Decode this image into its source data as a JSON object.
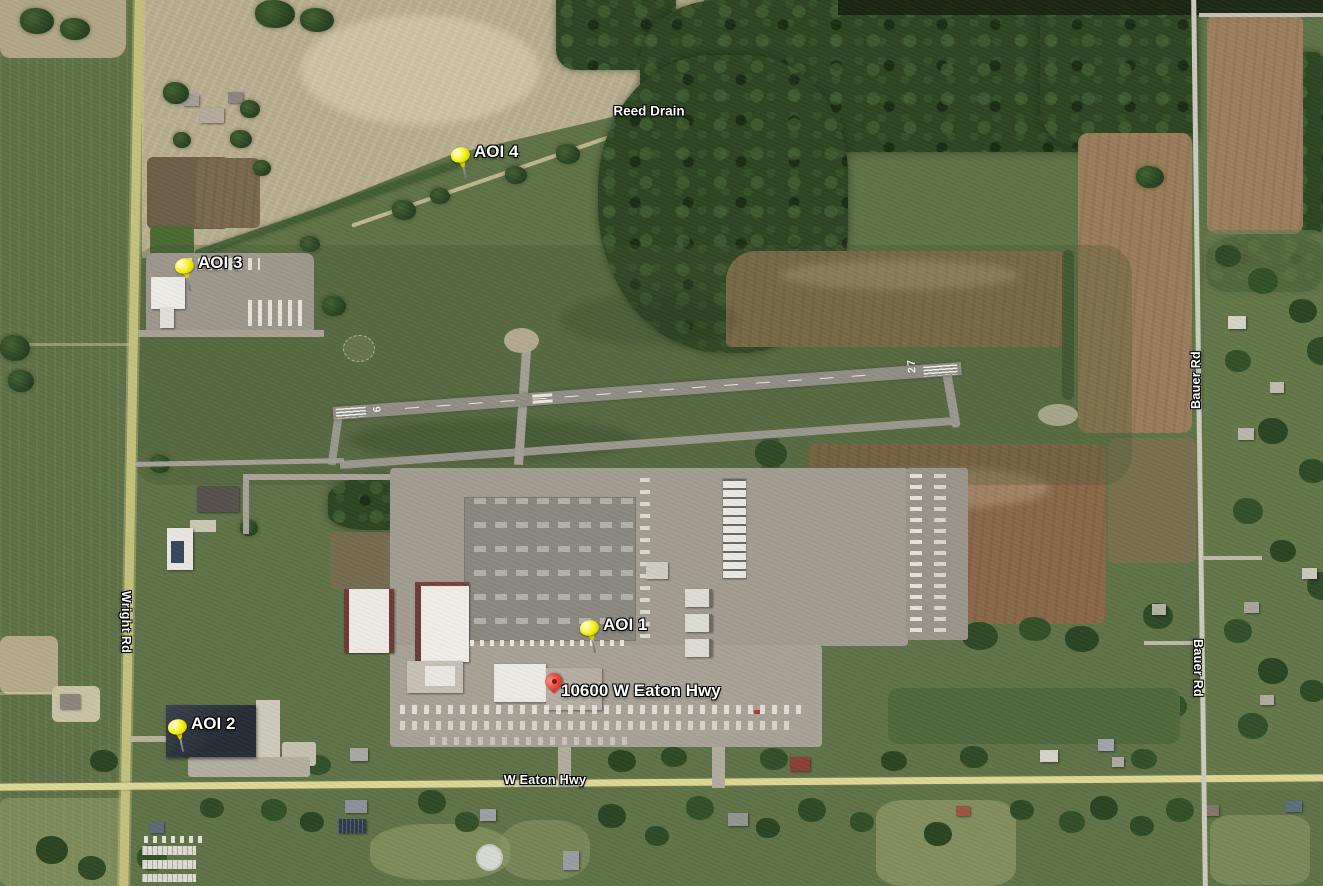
{
  "markers": {
    "pins": [
      {
        "id": "aoi-1",
        "label": "AOI 1",
        "x": 589,
        "y": 653,
        "type": "yellow-pushpin",
        "color": "#f6ec0e"
      },
      {
        "id": "aoi-2",
        "label": "AOI 2",
        "x": 177,
        "y": 752,
        "type": "yellow-pushpin",
        "color": "#f6ec0e"
      },
      {
        "id": "aoi-3",
        "label": "AOI 3",
        "x": 184,
        "y": 291,
        "type": "yellow-pushpin",
        "color": "#f6ec0e"
      },
      {
        "id": "aoi-4",
        "label": "AOI 4",
        "x": 460,
        "y": 180,
        "type": "yellow-pushpin",
        "color": "#f6ec0e"
      },
      {
        "id": "address",
        "label": "10600 W Eaton Hwy",
        "x": 554,
        "y": 698,
        "type": "red-map-pin",
        "color": "#e8463a"
      }
    ],
    "label_color": "#ffffff"
  },
  "road_labels": [
    {
      "text": "Wright Rd",
      "x": 126,
      "y": 622,
      "rotate": 90
    },
    {
      "text": "Bauer Rd",
      "x": 1196,
      "y": 380,
      "rotate": -90
    },
    {
      "text": "Bauer Rd",
      "x": 1198,
      "y": 668,
      "rotate": 90
    },
    {
      "text": "W Eaton Hwy",
      "x": 545,
      "y": 780,
      "rotate": 0
    }
  ],
  "terrain_labels": [
    {
      "text": "Reed Drain",
      "x": 649,
      "y": 111,
      "rotate": 0
    }
  ],
  "airport": {
    "runway_west_number": {
      "text": "9",
      "x": 376,
      "y": 410,
      "rotate": 86
    },
    "runway_east_number": {
      "text": "27",
      "x": 912,
      "y": 366,
      "rotate": -94
    }
  }
}
